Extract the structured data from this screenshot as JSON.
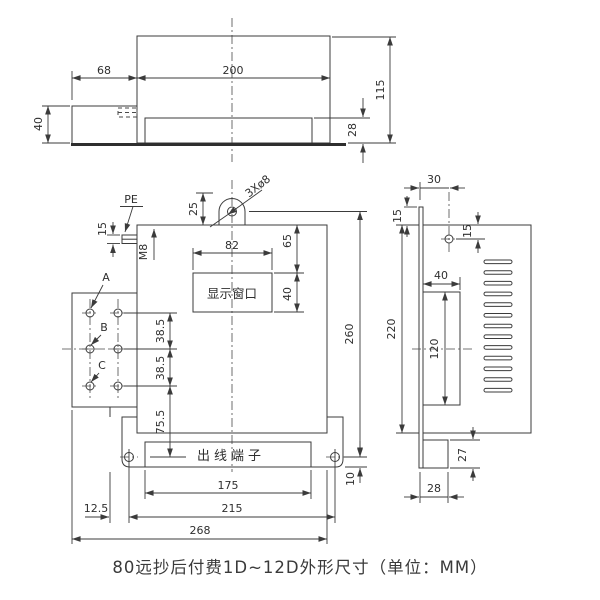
{
  "caption": "80远抄后付费1D~12D外形尺寸（单位：MM）",
  "top_view": {
    "dim_68": "68",
    "dim_200": "200",
    "dim_115": "115",
    "dim_28": "28",
    "dim_40": "40"
  },
  "front_view": {
    "label_pe": "PE",
    "label_m8": "M8",
    "label_holes": "3Xø8",
    "label_a": "A",
    "label_b": "B",
    "label_c": "C",
    "display_window": "显示窗口",
    "outlet_terminal": "出线端子",
    "dim_25": "25",
    "dim_15": "15",
    "dim_82": "82",
    "dim_65": "65",
    "dim_40": "40",
    "dim_38_5_a": "38.5",
    "dim_38_5_b": "38.5",
    "dim_75_5": "75.5",
    "dim_260": "260",
    "dim_10": "10",
    "dim_175": "175",
    "dim_215": "215",
    "dim_12_5": "12.5",
    "dim_268": "268"
  },
  "side_view": {
    "dim_30": "30",
    "dim_15_top": "15",
    "dim_15_hole": "15",
    "dim_220": "220",
    "dim_40": "40",
    "dim_120": "120",
    "dim_27": "27",
    "dim_28": "28"
  }
}
